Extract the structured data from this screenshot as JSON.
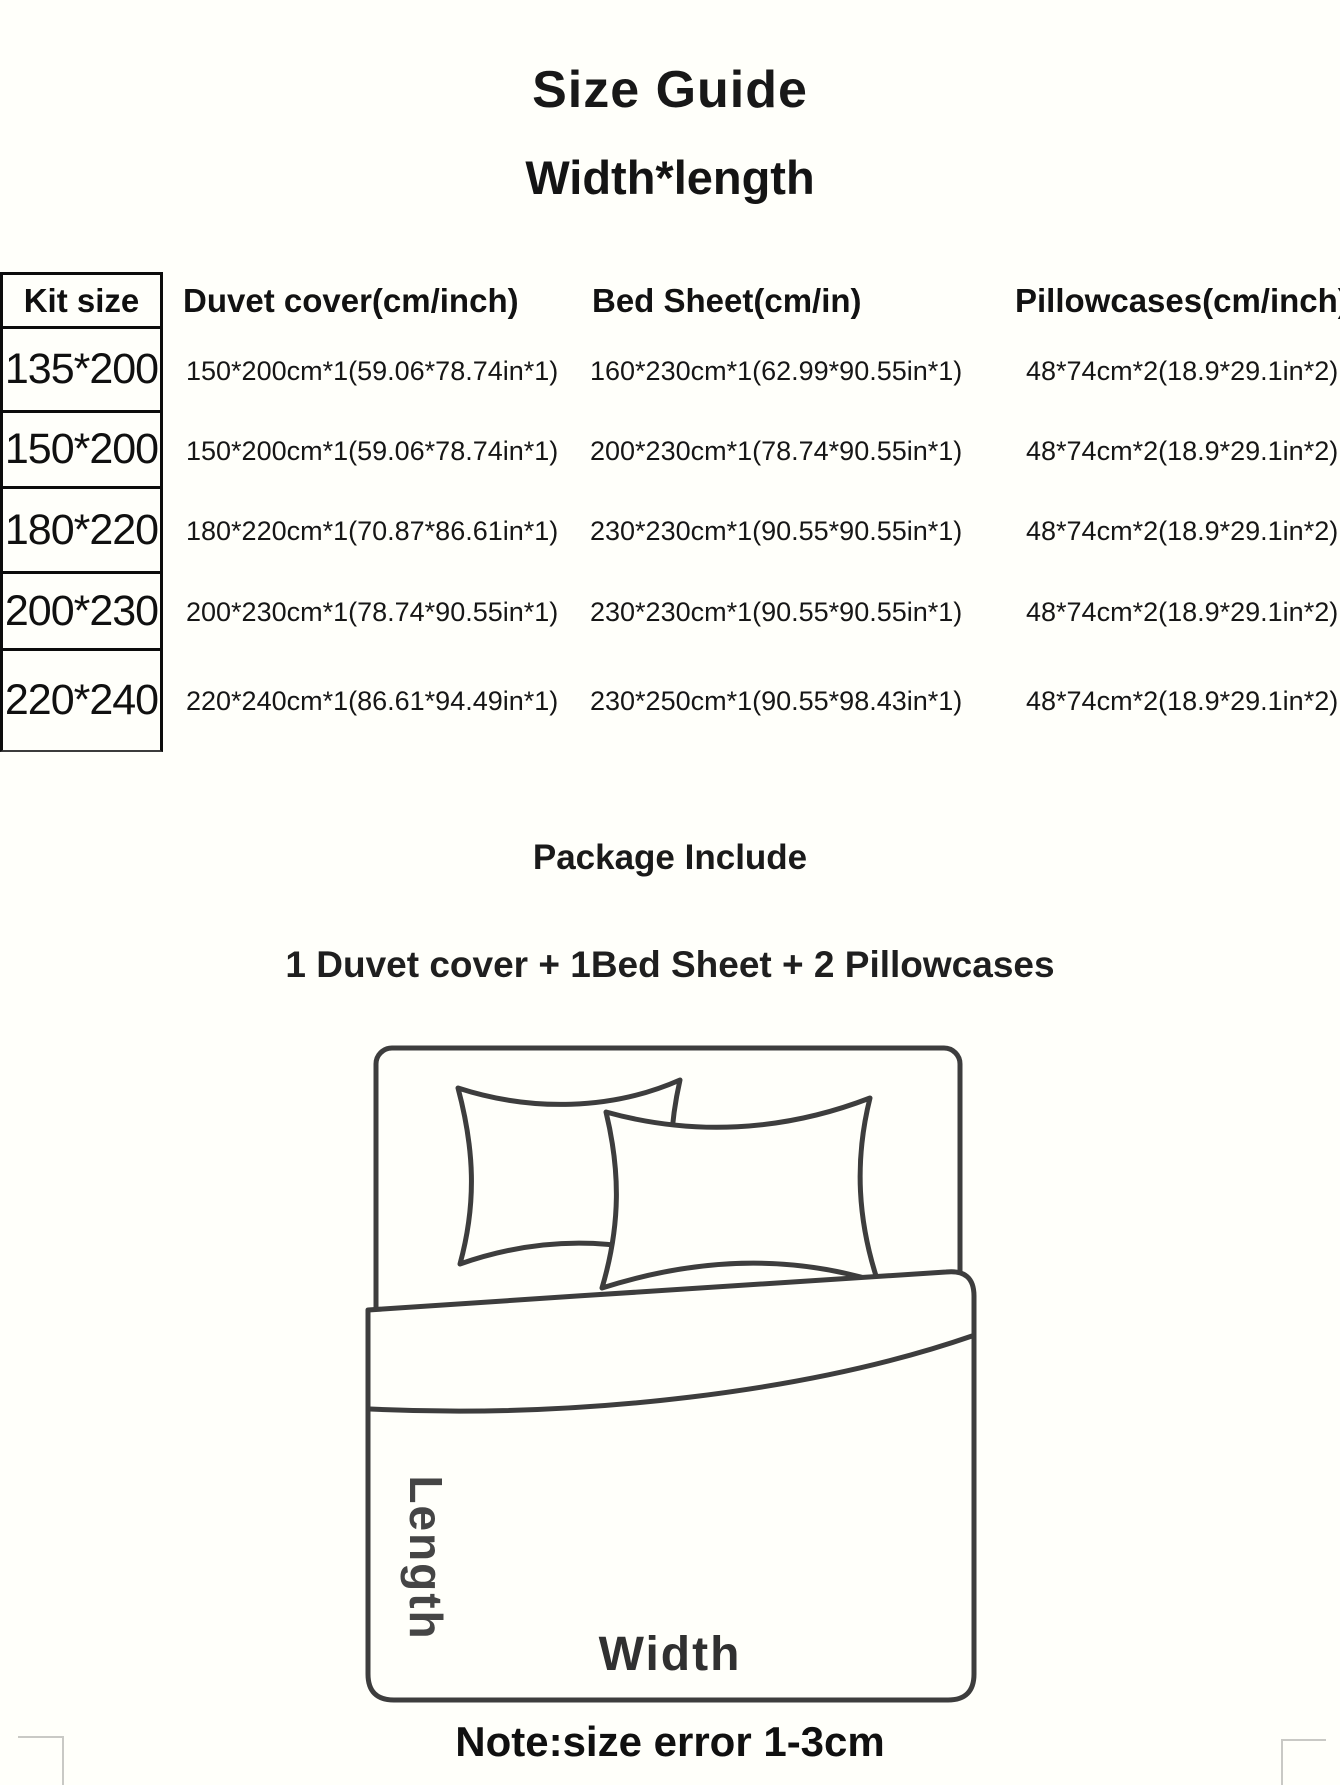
{
  "page": {
    "title": "Size Guide",
    "subtitle": "Width*length",
    "package_heading": "Package Include",
    "package_contents": "1 Duvet cover + 1Bed Sheet + 2 Pillowcases",
    "note": "Note:size error  1-3cm"
  },
  "size_table": {
    "columns": [
      "Kit size",
      "Duvet cover(cm/inch)",
      "Bed Sheet(cm/in)",
      "Pillowcases(cm/inch)"
    ],
    "rows": [
      {
        "kit_size": "135*200",
        "duvet_cover": "150*200cm*1(59.06*78.74in*1)",
        "bed_sheet": "160*230cm*1(62.99*90.55in*1)",
        "pillowcases": "48*74cm*2(18.9*29.1in*2)"
      },
      {
        "kit_size": "150*200",
        "duvet_cover": "150*200cm*1(59.06*78.74in*1)",
        "bed_sheet": "200*230cm*1(78.74*90.55in*1)",
        "pillowcases": "48*74cm*2(18.9*29.1in*2)"
      },
      {
        "kit_size": "180*220",
        "duvet_cover": "180*220cm*1(70.87*86.61in*1)",
        "bed_sheet": "230*230cm*1(90.55*90.55in*1)",
        "pillowcases": "48*74cm*2(18.9*29.1in*2)"
      },
      {
        "kit_size": "200*230",
        "duvet_cover": "200*230cm*1(78.74*90.55in*1)",
        "bed_sheet": "230*230cm*1(90.55*90.55in*1)",
        "pillowcases": "48*74cm*2(18.9*29.1in*2)"
      },
      {
        "kit_size": "220*240",
        "duvet_cover": "220*240cm*1(86.61*94.49in*1)",
        "bed_sheet": "230*250cm*1(90.55*98.43in*1)",
        "pillowcases": "48*74cm*2(18.9*29.1in*2)"
      }
    ]
  },
  "diagram": {
    "length_label": "Length",
    "width_label": "Width"
  },
  "colors": {
    "background": "#fffffa",
    "text": "#1c1c1c",
    "diagram_line": "#3d3d3d"
  }
}
